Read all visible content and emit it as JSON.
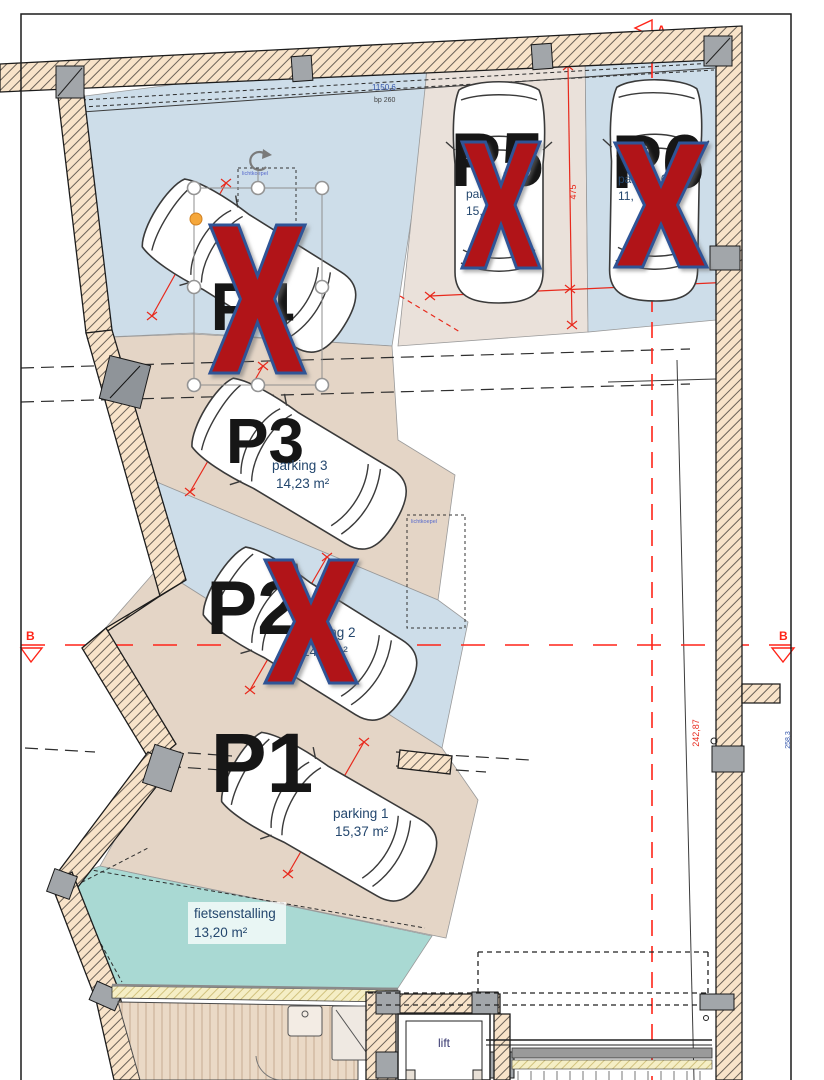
{
  "spots": {
    "p1": {
      "label": "P1",
      "name": "parking 1",
      "area": "15,37 m²",
      "sold": false
    },
    "p2": {
      "label": "P2",
      "name": "parking 2",
      "area": "14,3 m²",
      "sold": true
    },
    "p3": {
      "label": "P3",
      "name": "parking 3",
      "area": "14,23 m²",
      "sold": false
    },
    "p4": {
      "label": "P4",
      "sold": true
    },
    "p5": {
      "label": "P5",
      "name": "parking 5",
      "area": "15,",
      "sold": true
    },
    "p6": {
      "label": "P6",
      "name": "parking 6",
      "area": "11,",
      "sold": true
    }
  },
  "rooms": {
    "fietsenstalling": {
      "name": "fietsenstalling",
      "area": "13,20 m²"
    },
    "lift": {
      "name": "lift"
    }
  },
  "dimensions": {
    "top_length": "1150,6",
    "top_sub": "bp 260",
    "bay_depth": "475",
    "p5_width": "240",
    "p6_width": "240",
    "p4_width": "240",
    "p3_width": "240",
    "p2_width": "240",
    "p1_width": "250",
    "right_height": "242,87",
    "right_height2": "258,3"
  },
  "sections": {
    "a": "A",
    "b": "B"
  },
  "skylight": {
    "label": "lichtkoepel"
  },
  "colors": {
    "strip_blue": "#cdddе9",
    "strip_tan": "#e4d5c6",
    "strip_greige": "#eae1da",
    "bike_teal": "#a9d9d3",
    "wall_fill": "#f8e3c9",
    "sold_x": "#b11418",
    "x_outline": "#2f5496",
    "dim_red": "#e8291c",
    "text_blue": "#24476e"
  }
}
